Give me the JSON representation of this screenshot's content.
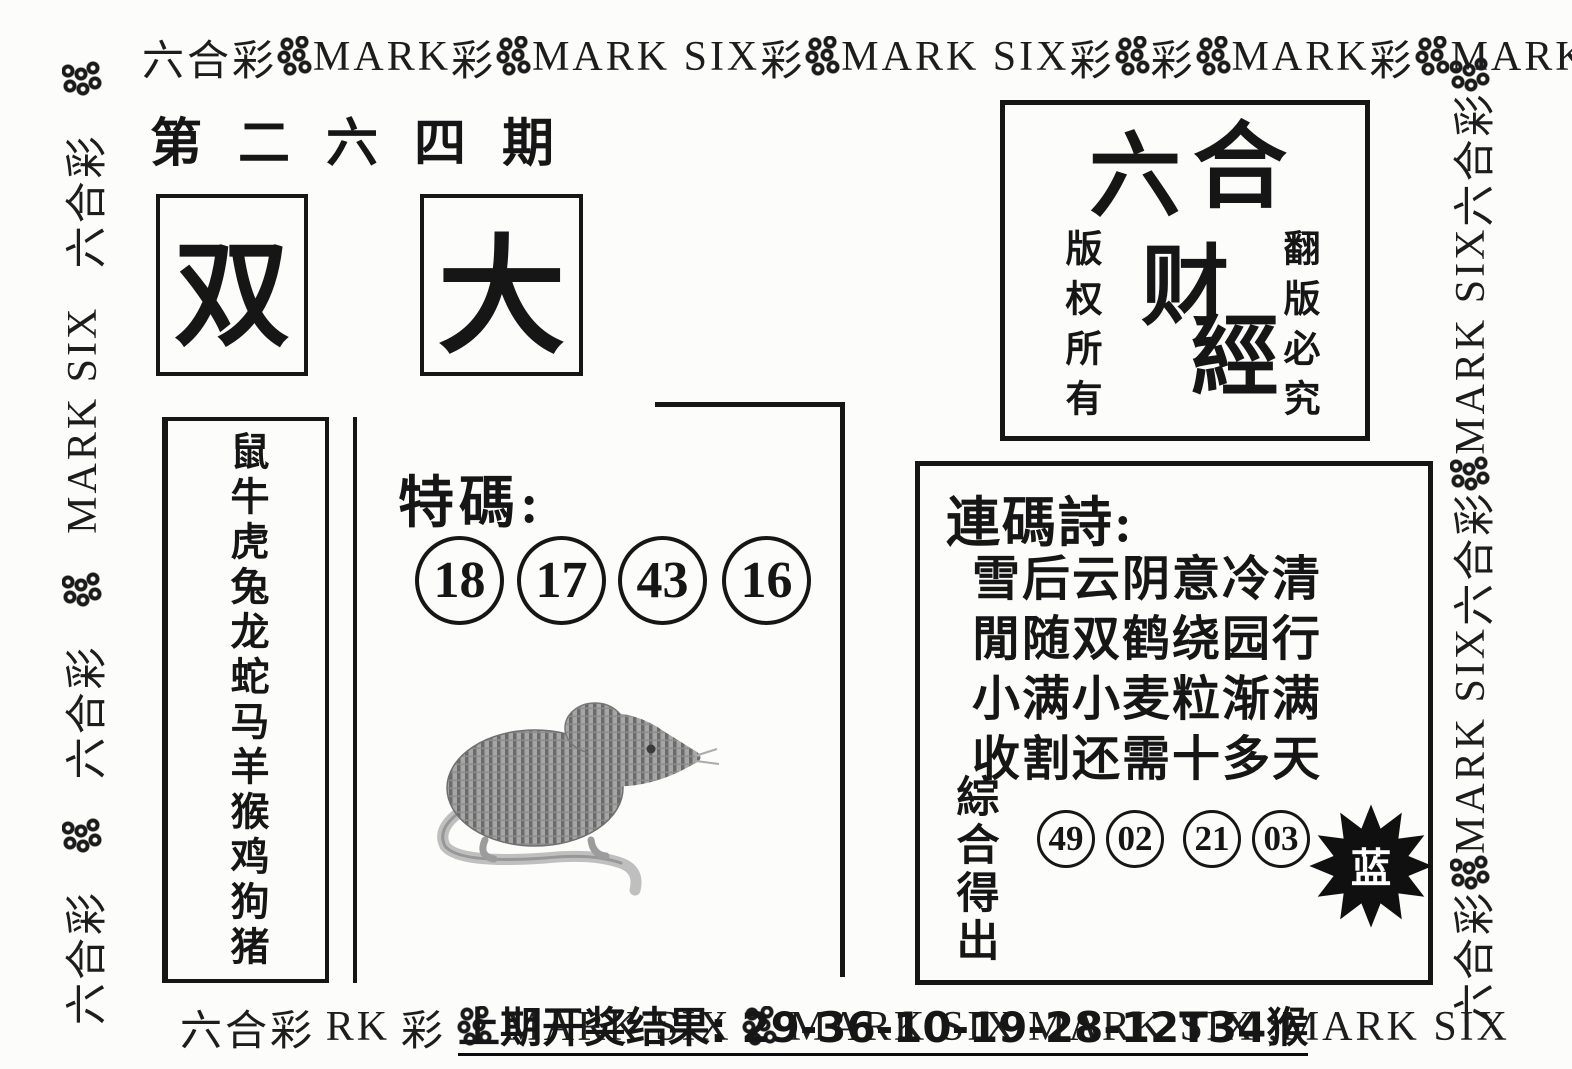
{
  "header": {
    "issue_title": "第二六四期"
  },
  "badges": {
    "double": "双",
    "big": "大"
  },
  "zodiac": {
    "animals": "鼠牛虎兔龙蛇马羊猴鸡狗猪"
  },
  "special": {
    "label": "特碼:",
    "numbers": [
      "18",
      "17",
      "43",
      "16"
    ]
  },
  "masthead": {
    "chars": [
      "六",
      "合",
      "财",
      "經"
    ],
    "left_vertical": "版权所有",
    "right_vertical": "翻版必究"
  },
  "poem": {
    "label": "連碼詩:",
    "lines": [
      "雪后云阴意冷清",
      "閒随双鹤绕园行",
      "小满小麦粒渐满",
      "收割还需十多天"
    ],
    "summary_label": "綜合得出",
    "numbers": [
      "49",
      "02",
      "21",
      "03"
    ],
    "burst_label": "蓝"
  },
  "footer": {
    "last_result": "上期开奖结果: 29-36-10-19-28-12T34猴"
  },
  "borders": {
    "top": [
      "六合彩",
      "MARK",
      "彩",
      "MARK SIX",
      "彩",
      "MARK SIX",
      "彩",
      "彩",
      "MARK",
      "彩",
      "MARK SIX",
      "六合IX"
    ],
    "bottom": [
      "六合彩",
      "RK",
      "彩",
      "MARK SIX",
      "MARK SIX",
      "MARK SIX",
      ";MARK SIX"
    ],
    "left": [
      "六合彩",
      "六合彩",
      "MARK SIX",
      "六合彩"
    ],
    "right": [
      "六合彩",
      "MARK SIX",
      "六合彩",
      "MARK SIX",
      "六合彩"
    ]
  },
  "colors": {
    "ink": "#161616",
    "paper": "#fcfcfb",
    "burst_fill": "#101010",
    "burst_text": "#ffffff",
    "rat_gray": "#8f8f8f"
  }
}
